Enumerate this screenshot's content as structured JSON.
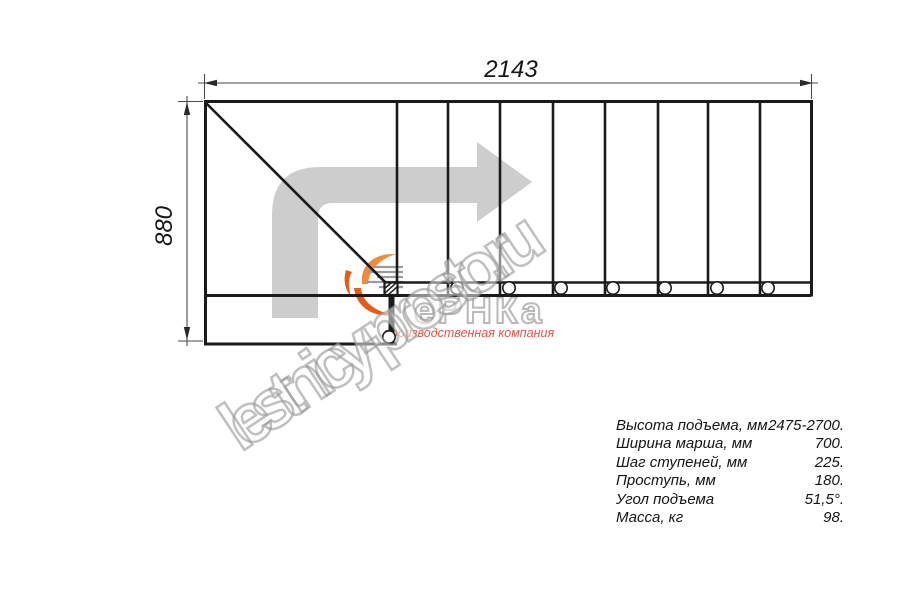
{
  "dimensions": {
    "width_label": "2143",
    "height_label": "880"
  },
  "specs": {
    "rows": [
      {
        "label": "Высота подъема, мм",
        "value": "2475-2700."
      },
      {
        "label": "Ширина марша, мм",
        "value": "700."
      },
      {
        "label": "Шаг ступеней, мм",
        "value": "225."
      },
      {
        "label": "Проступь, мм",
        "value": "180."
      },
      {
        "label": "Угол подъема",
        "value": "51,5°."
      },
      {
        "label": "Масса, кг",
        "value": "98."
      }
    ]
  },
  "watermark": {
    "text": "lestnicy-prosto.ru"
  },
  "logo": {
    "wordmark": "еРНКа",
    "subtitle": "производственная компания"
  },
  "plan": {
    "tread_count": 8,
    "riser_x": [
      397,
      448,
      500,
      553,
      605,
      658,
      708,
      760
    ],
    "baluster_x": [
      457,
      509,
      561,
      613,
      665,
      717,
      768
    ],
    "baluster_y": 288,
    "landing_baluster": {
      "x": 389,
      "y": 337
    }
  },
  "colors": {
    "line": "#1b1b1b",
    "dim_line": "#4a4a4a",
    "arrow_gray": "#cdcdcd",
    "logo_orange_light": "#f08a3c",
    "logo_orange_dark": "#ea5a17",
    "logo_red_text": "#e0544a",
    "watermark_outline": "#b5b5b5"
  }
}
